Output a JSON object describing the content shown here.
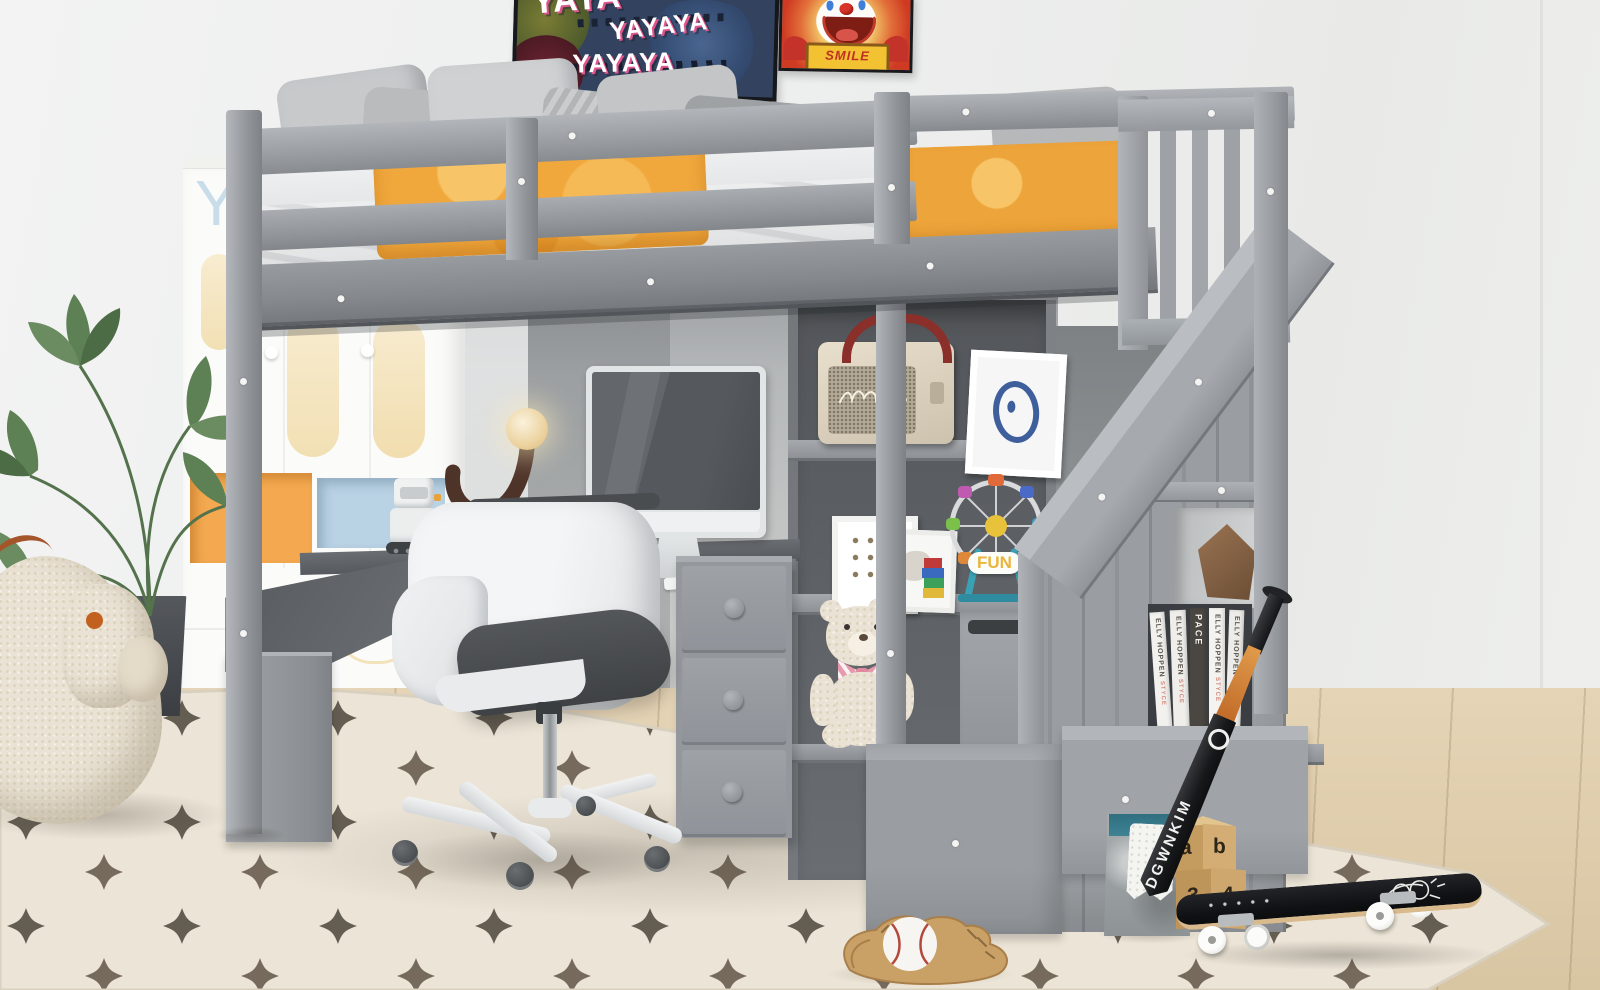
{
  "scene": {
    "description": "Kids bedroom: gray wooden loft bed with storage staircase, desk with monitor and chair underneath, shelves with speaker, frames, ferris-wheel toy and teddy bear; rug with dark star pattern; plant, plush sheep, skateboard, bat, baseball glove"
  },
  "posters": {
    "graffiti": {
      "line1": "YAYA",
      "line2": "YAYAYA",
      "line3": "YAYAYA",
      "background": "#32425f",
      "text_color": "#ffffff",
      "shadow_color": "#e0548e"
    },
    "clown": {
      "sign_text": "SMILE",
      "background": "#cf3a22",
      "sign_color": "#f2c233",
      "sign_text_color": "#c03124"
    }
  },
  "wardrobe": {
    "letter": "Y",
    "oval_accent": "#f5e4ba",
    "cubby_orange": "#f4a950",
    "cubby_blue": "#b9d2e4"
  },
  "ferris_wheel": {
    "label": "FUN",
    "label_color": "#e9b63c"
  },
  "blocks": {
    "top_left": "a",
    "top_right": "b",
    "bottom_left": "3",
    "bottom_right": "4",
    "wood_color": "#c9a368"
  },
  "books": {
    "title": "ELLY HOPPEN",
    "subtitle": "STYCE",
    "dark_spine": "PACE"
  },
  "bat": {
    "text": "DGWNKIM",
    "grip_color": "#d98a3a",
    "body_color": "#1c1d1f"
  },
  "palette": {
    "bed_frame": "#9a9ea2",
    "blanket_orange": "#f0a73c",
    "rug_base": "#ece5d7",
    "rug_star": "#3b3429",
    "wall": "#eceded",
    "wood_floor": "#dcc9a7",
    "basket_teal": "#3e8294",
    "plush_cream": "#eae2d4",
    "desk_top": "#5b5f63"
  }
}
